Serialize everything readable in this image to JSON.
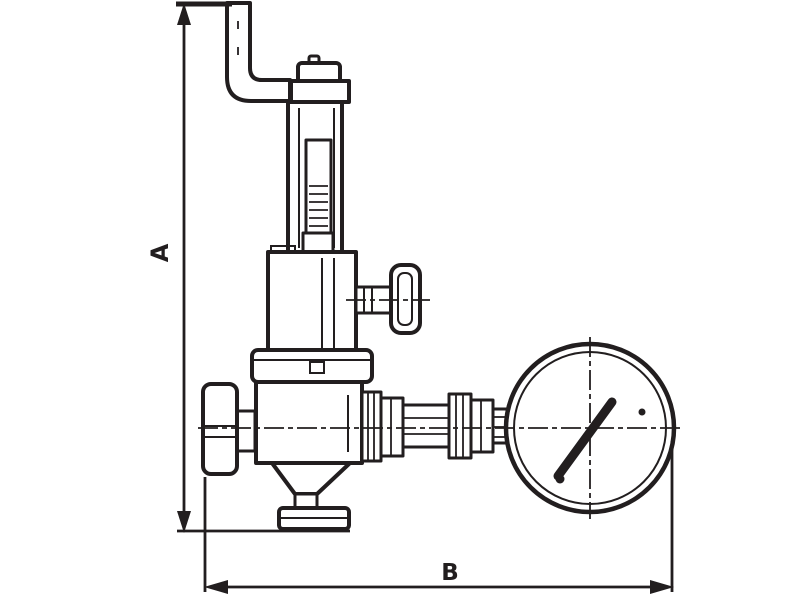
{
  "figure": {
    "kind": "technical line drawing",
    "subject": "pressure reducing valve with discharge pipe and pressure gauge",
    "background_color": "#ffffff",
    "line_color": "#221e1f"
  },
  "dimensions": {
    "vertical_label": "A",
    "horizontal_label": "B"
  },
  "components": [
    "discharge-pipe",
    "spring-housing",
    "adjusting-screw",
    "bonnet",
    "side-tee-handle",
    "diaphragm-flange",
    "valve-body",
    "inlet-cap",
    "bottom-outlet-flange",
    "gauge-pipe-fittings",
    "pressure-gauge",
    "gauge-needle"
  ]
}
